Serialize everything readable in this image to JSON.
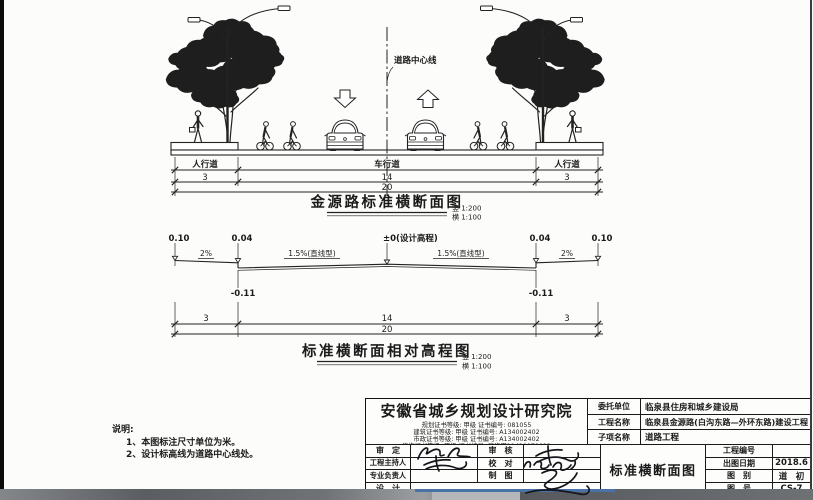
{
  "section": {
    "centerline_label": "道路中心线",
    "lane_labels": {
      "left": "人行道",
      "center": "车行道",
      "right": "人行道"
    },
    "dims": {
      "left": "3",
      "center": "14",
      "right": "3",
      "total": "20"
    },
    "title": "金源路标准横断面图",
    "scale_v": "竖 1:200",
    "scale_h": "横 1:100"
  },
  "elevation": {
    "title": "标准横断面相对高程图",
    "scale_v": "竖 1:200",
    "scale_h": "横 1:100",
    "levels": {
      "edge_l": "0.10",
      "curb_l": "0.04",
      "center": "±0(设计高程)",
      "curb_r": "0.04",
      "edge_r": "0.10",
      "gutter_l": "-0.11",
      "gutter_r": "-0.11"
    },
    "slopes": {
      "walk_l": "2%",
      "lane_l": "1.5%(直线型)",
      "lane_r": "1.5%(直线型)",
      "walk_r": "2%"
    },
    "dims": {
      "left": "3",
      "center": "14",
      "right": "3",
      "total": "20"
    }
  },
  "notes": {
    "heading": "说明:",
    "item1": "1、本图标注尺寸单位为米。",
    "item2": "2、设计标高线为道路中心线处。"
  },
  "titleblock": {
    "institute": "安徽省城乡规划设计研究院",
    "certs": [
      "规划证书等级: 甲级 证书编号: 081055",
      "建筑证书等级: 甲级 证书编号: A134002402",
      "市政证书等级: 甲级 证书编号: A134002402",
      "咨询证书等级: 甲级 证书编号: 工咨甲11420070022"
    ],
    "client_label": "委托单位",
    "client": "临泉县住房和城乡建设局",
    "project_label": "工程名称",
    "project": "临泉县金源路(白沟东路—外环东路)建设工程",
    "subitem_label": "子项名称",
    "subitem": "道路工程",
    "sign_rows": [
      {
        "l": "审　定",
        "r": "审　核"
      },
      {
        "l": "工程主持人",
        "r": "校　对"
      },
      {
        "l": "专业负责人",
        "r": "制　图"
      },
      {
        "l": "设　计",
        "r": ""
      }
    ],
    "drawing_title": "标准横断面图",
    "project_no_label": "工程编号",
    "project_no": "",
    "date_label": "出图日期",
    "date": "2018.6",
    "category_label": "图　别",
    "category": "道　初",
    "sheet_label": "图　号",
    "sheet": "CS-7"
  }
}
